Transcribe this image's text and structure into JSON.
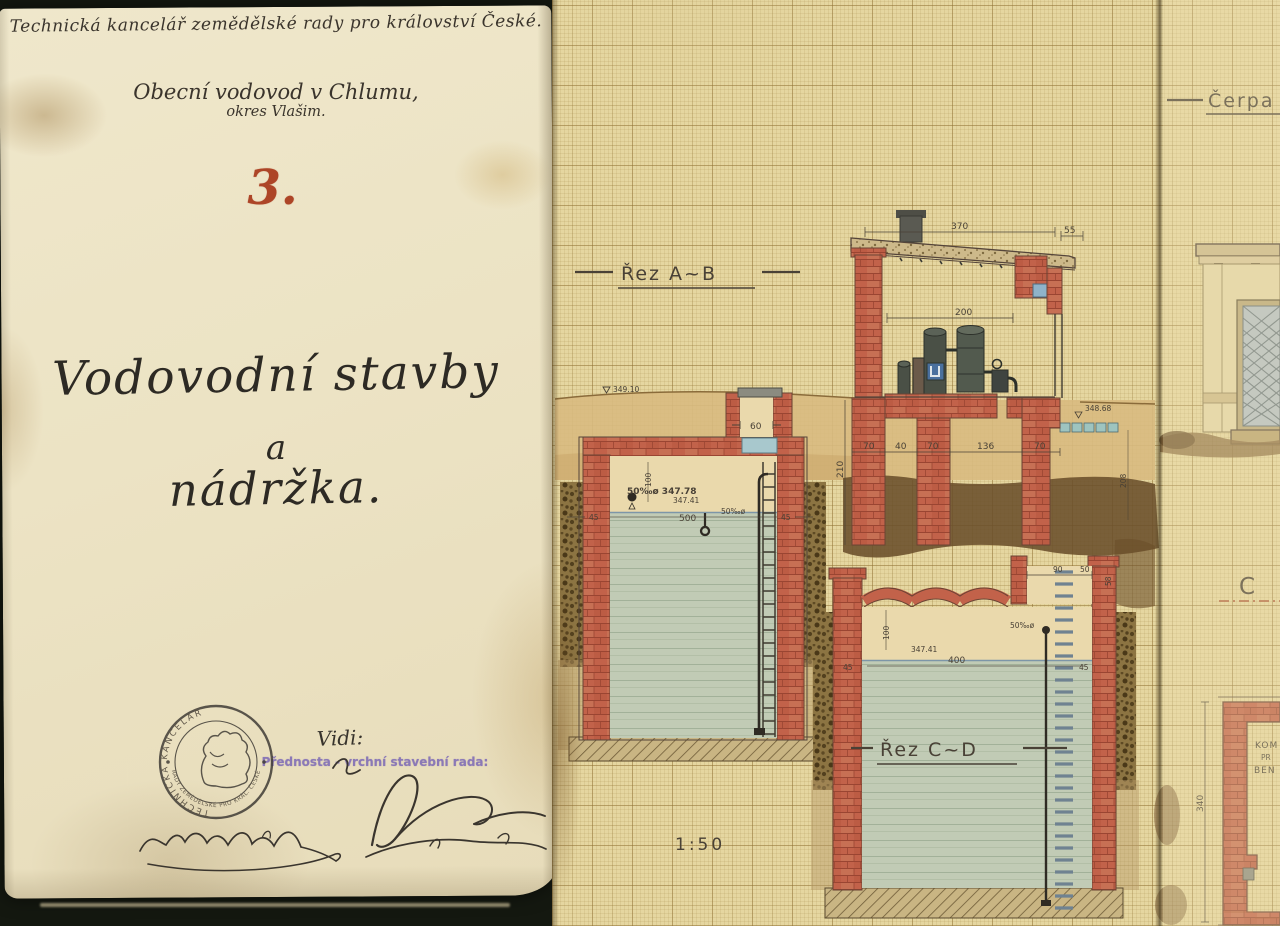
{
  "cover": {
    "header": "Technická kancelář zemědělské rady pro království České.",
    "project_line1": "Obecní vodovod v Chlumu,",
    "project_line2": "okres Vlašim.",
    "sheet_number": "3.",
    "title_line1": "Vodovodní stavby",
    "title_line2": "a",
    "title_line3": "nádržka.",
    "vidi": "Vidi:",
    "approval_role": "Přednosta - vrchní stavební rada:",
    "seal_top": "TECHNICKÁ KANCELÁŘ",
    "seal_bottom": "RADY ZEMĚDĚLSKÉ PRO KRÁL. ČESKÉ"
  },
  "drawing": {
    "label_section_ab": "Řez A~B",
    "label_section_cd": "Řez C~D",
    "label_pump_station": "Čerpa",
    "scale": "1:50",
    "label_section_c": "C",
    "chamber_text": [
      "KOM",
      "PR",
      "BEN"
    ],
    "dims": [
      "370",
      "55",
      "200",
      "348.68",
      "60",
      "349.10",
      "210",
      "70",
      "40",
      "70",
      "136",
      "70",
      "50‰ø 347.78",
      "347.41",
      "500",
      "50‰ø",
      "45",
      "45",
      "100",
      "400",
      "347.41",
      "50‰ø",
      "90",
      "50",
      "58",
      "45",
      "45",
      "340",
      "208",
      "100"
    ]
  },
  "colors": {
    "brick": "#c2624a",
    "water": "#c1cbb5",
    "cover_paper": "#ece3c4",
    "grid_paper": "#e5d6a0",
    "ink": "#494136",
    "number_red": "#ad4527",
    "stamp_purple": "#7b68b5"
  }
}
